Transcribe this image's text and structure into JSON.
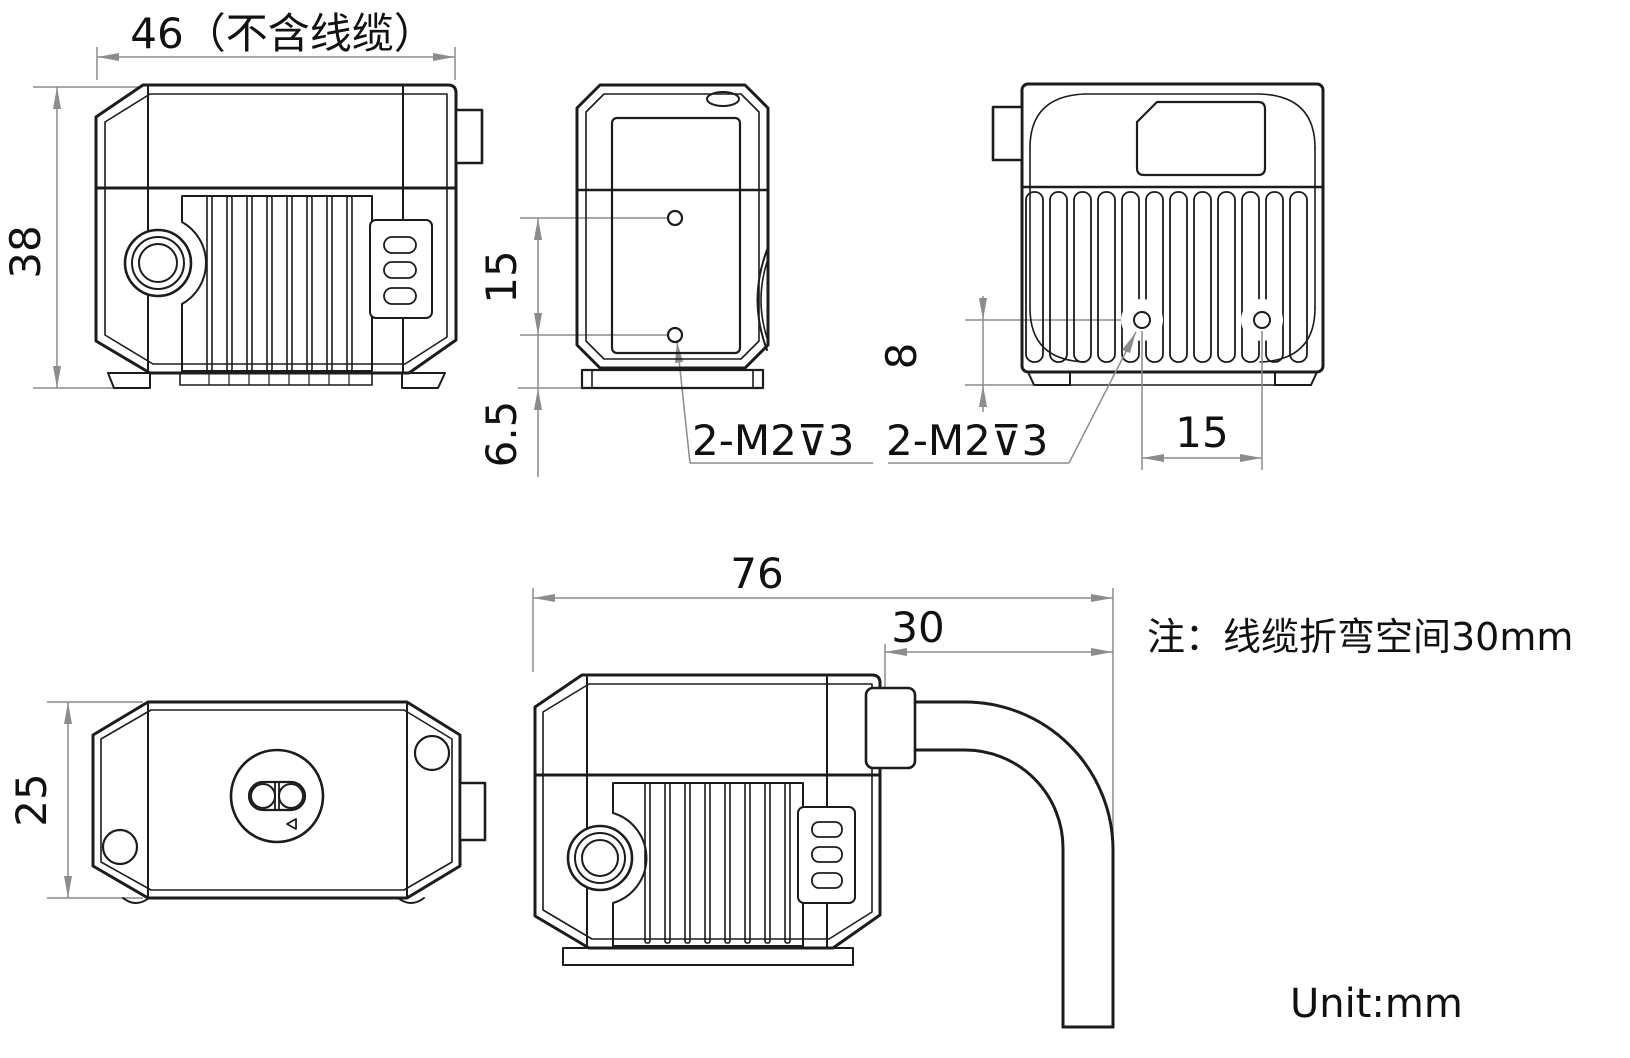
{
  "drawing": {
    "unit_label": "Unit:mm",
    "note": "注：线缆折弯空间30mm",
    "front": {
      "width_label": "46（不含线缆）",
      "height_label": "38"
    },
    "side": {
      "hole_spacing_label": "15",
      "hole_offset_label": "6.5",
      "thread_label": "2-M2⊽3"
    },
    "rear": {
      "hole_offset_label": "8",
      "hole_spacing_label": "15",
      "thread_label": "2-M2⊽3"
    },
    "top": {
      "depth_label": "25"
    },
    "cable": {
      "overall_label": "76",
      "bend_label": "30"
    }
  },
  "colors": {
    "line": "#1c1c1c",
    "dim": "#8c8c8c",
    "txt": "#111111",
    "bg": "#ffffff"
  }
}
